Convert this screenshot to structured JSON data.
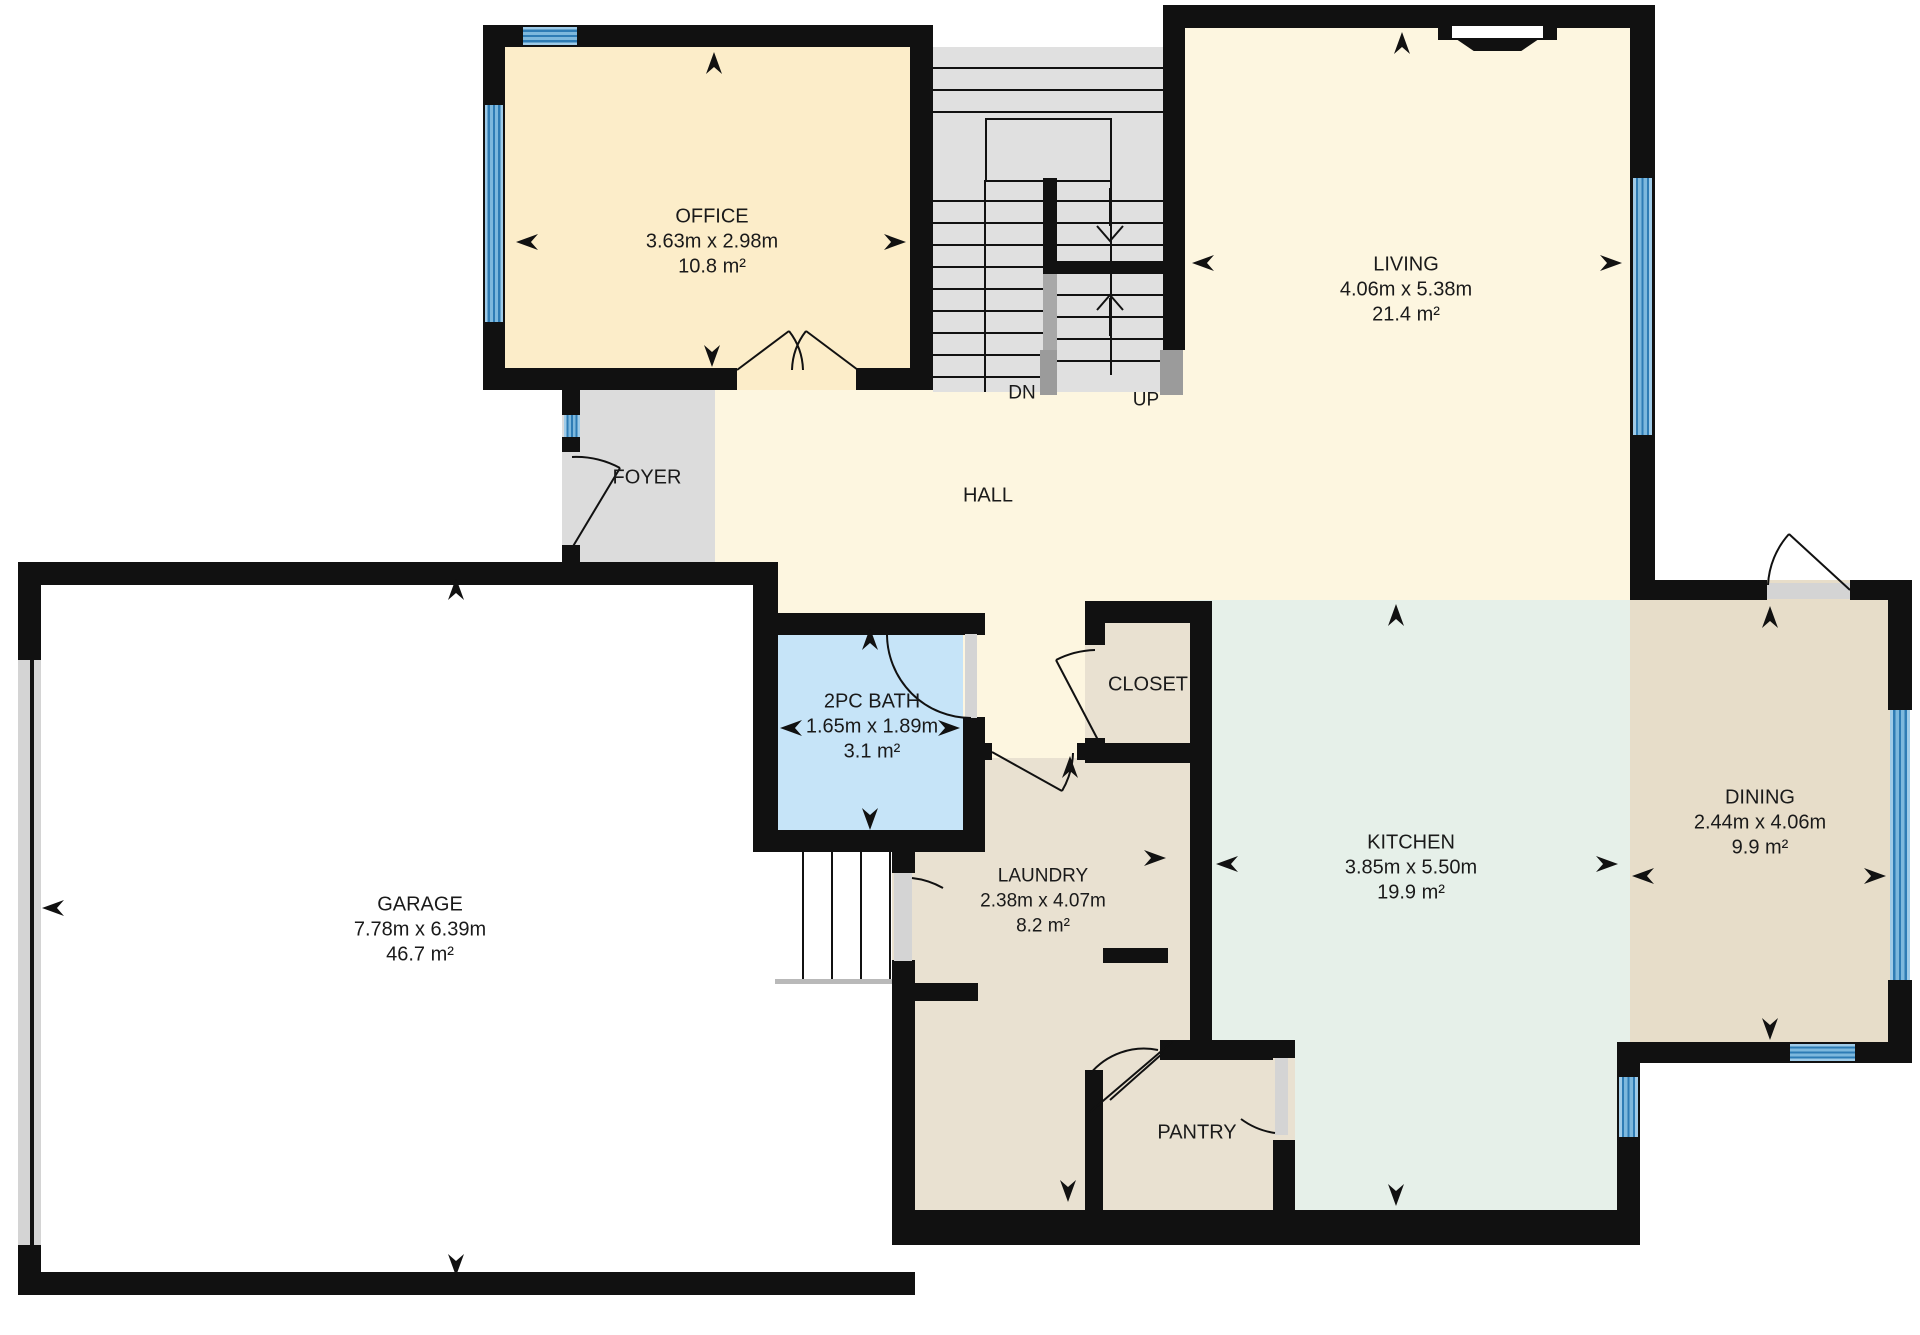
{
  "floorplan": {
    "rooms": {
      "office": {
        "name": "OFFICE",
        "dimensions": "3.63m x 2.98m",
        "area": "10.8 m²"
      },
      "living": {
        "name": "LIVING",
        "dimensions": "4.06m x 5.38m",
        "area": "21.4 m²"
      },
      "hall": {
        "name": "HALL"
      },
      "foyer": {
        "name": "FOYER"
      },
      "garage": {
        "name": "GARAGE",
        "dimensions": "7.78m x 6.39m",
        "area": "46.7 m²"
      },
      "bath": {
        "name": "2PC BATH",
        "dimensions": "1.65m x 1.89m",
        "area": "3.1 m²"
      },
      "closet": {
        "name": "CLOSET"
      },
      "laundry": {
        "name": "LAUNDRY",
        "dimensions": "2.38m x 4.07m",
        "area": "8.2 m²"
      },
      "kitchen": {
        "name": "KITCHEN",
        "dimensions": "3.85m x 5.50m",
        "area": "19.9 m²"
      },
      "pantry": {
        "name": "PANTRY"
      },
      "dining": {
        "name": "DINING",
        "dimensions": "2.44m x 4.06m",
        "area": "9.9 m²"
      }
    },
    "stairs": {
      "down": "DN",
      "up": "UP"
    },
    "colors": {
      "wall": "#111111",
      "window_blue": "#7db8dd",
      "hall_cream": "#fdf6e0",
      "office_cream": "#fcedc9",
      "bath_blue": "#c6e4f8",
      "utility_tan": "#e9e1d1",
      "kitchen_mint": "#e6f0e9",
      "dining_tan": "#e7ddc9",
      "stairs_gray": "#e0e0e0",
      "foyer_gray": "#dcdcdc",
      "door_gray": "#d4d4d4"
    }
  }
}
